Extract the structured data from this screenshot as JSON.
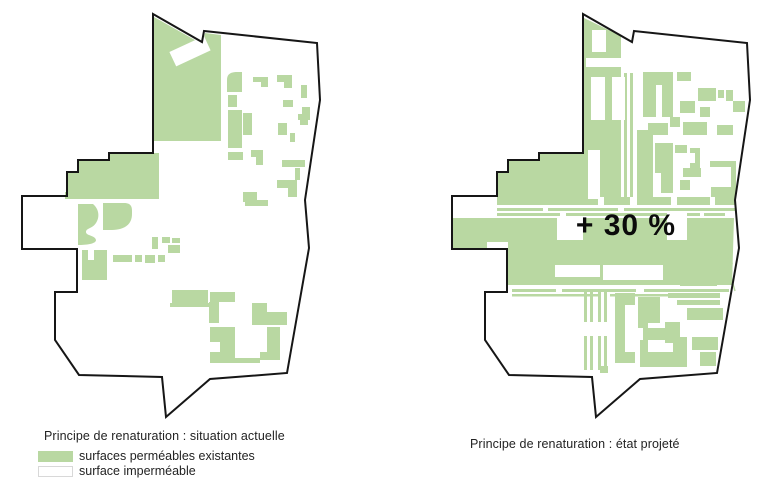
{
  "colors": {
    "permeable_green": "#b9d8a2",
    "outline": "#161616",
    "swatch_border": "#d8d8d8",
    "caption_text": "#232323",
    "annotation_text": "#0b0b0b"
  },
  "left_map": {
    "caption": "Principe de renaturation : situation actuelle",
    "legend": [
      {
        "swatch": "permeable",
        "label": "surfaces perméables existantes"
      },
      {
        "swatch": "impermeable",
        "label": "surface imperméable"
      }
    ],
    "boundary": "M153,14 L202,42 L204,31 L317,43 L320,100 L305,200 L309,248 L287,373 L210,379 L166,417 L162,377 L79,375 L55,340 L55,292 L77,292 L77,249 L22,249 L22,196 L67,196 L67,172 L78,172 L78,160 L109,160 L109,153 L153,153 Z",
    "green_shapes": [
      "M154,17 L202,44 L205,33 L221,35 L221,141 L154,141 Z",
      "M109,153 L159,153 L159,199 L65,199 L65,192 L67,192 L67,172 L78,172 L78,160 L109,160 Z",
      "M78,204 L93,204 C99,209 100,217 96,223 C92,229 86,228 86,232 C86,236 95,235 96,240 C96,244 86,245 78,245 Z",
      "M103,203 L124,203 C131,203 132,207 132,211 L132,214 C132,226 122,230 112,230 L103,230 Z",
      "M82,250 L88,250 L88,260 L94,260 L94,250 L107,250 L107,280 L82,280 Z",
      [
        113,
        255,
        19,
        7
      ],
      [
        135,
        255,
        7,
        7
      ],
      [
        145,
        255,
        10,
        8
      ],
      [
        158,
        255,
        7,
        7
      ],
      [
        152,
        237,
        6,
        12
      ],
      [
        162,
        237,
        8,
        6
      ],
      [
        172,
        238,
        8,
        5
      ],
      [
        168,
        245,
        12,
        8
      ],
      "M227,92 L227,80 C227,73 232,72 238,72 L242,72 L242,92 Z",
      "M253,77 L268,77 L268,87 L261,87 L261,82 L253,82 Z",
      "M277,75 L292,75 L292,88 L284,88 L284,82 L277,82 Z",
      [
        301,
        85,
        6,
        13
      ],
      [
        228,
        95,
        9,
        12
      ],
      [
        228,
        110,
        14,
        38
      ],
      [
        243,
        113,
        9,
        22
      ],
      [
        283,
        100,
        10,
        7
      ],
      "M302,107 L310,107 L310,120 L298,120 L298,114 L302,114 Z",
      [
        278,
        123,
        9,
        12
      ],
      [
        290,
        133,
        5,
        9
      ],
      [
        300,
        120,
        8,
        5
      ],
      [
        228,
        152,
        15,
        8
      ],
      "M251,150 L263,150 L263,165 L256,165 L256,157 L251,157 Z",
      [
        282,
        160,
        23,
        7
      ],
      [
        295,
        168,
        5,
        12
      ],
      "M277,180 L297,180 L297,197 L288,197 L288,188 L277,188 Z",
      [
        243,
        192,
        14,
        10
      ],
      [
        245,
        200,
        23,
        6
      ],
      [
        172,
        290,
        36,
        13
      ],
      [
        170,
        303,
        39,
        4
      ],
      [
        210,
        292,
        25,
        10
      ],
      [
        209,
        302,
        10,
        21
      ],
      "M210,327 L235,327 L235,363 L210,363 L210,352 L220,352 L220,342 L210,342 Z",
      "M252,303 L267,303 L267,312 L287,312 L287,325 L252,325 Z",
      "M267,327 L280,327 L280,360 L260,360 L260,352 L267,352 Z",
      [
        235,
        358,
        25,
        5
      ]
    ],
    "white_shapes": [
      "M204,36 L210.6,50.4 L176.2,66.4 L169.4,52 Z"
    ]
  },
  "right_map": {
    "caption": "Principe de renaturation : état projeté",
    "annotation": "+ 30 %",
    "boundary": "M583,14 L632,42 L634,31 L747,43 L750,100 L735,200 L739,248 L717,373 L640,379 L596,417 L592,377 L509,375 L485,340 L485,292 L507,292 L507,249 L452,249 L452,196 L497,196 L497,172 L508,172 L508,160 L539,160 L539,153 L583,153 Z",
    "green_shapes": [
      "M584,18 L621,36 L621,150 L584,150 Z",
      [
        584,
        150,
        37,
        47
      ],
      "M539,154 L584,154 L584,199 L497,199 L497,172 L508,172 L508,160 L539,160 Z",
      [
        497,
        197,
        101,
        8
      ],
      [
        604,
        197,
        26,
        8
      ],
      [
        637,
        197,
        34,
        8
      ],
      [
        677,
        197,
        33,
        8
      ],
      [
        715,
        197,
        20,
        8
      ],
      [
        497,
        208,
        46,
        3
      ],
      [
        548,
        208,
        70,
        3
      ],
      [
        624,
        208,
        111,
        3
      ],
      [
        497,
        213,
        63,
        3
      ],
      [
        566,
        213,
        134,
        3
      ],
      [
        704,
        213,
        21,
        3
      ],
      "M453,218 L734,218 L732,285 L507,285 L507,249 L453,249 Z",
      [
        512,
        289,
        44,
        3
      ],
      [
        562,
        289,
        74,
        3
      ],
      [
        644,
        289,
        85,
        3
      ],
      [
        512,
        294,
        88,
        2.5
      ],
      [
        610,
        294,
        80,
        2.5
      ],
      [
        680,
        283,
        37,
        3
      ],
      [
        624,
        73,
        3,
        124
      ],
      [
        630,
        73,
        3,
        124
      ],
      [
        643,
        72,
        30,
        45
      ],
      [
        677,
        72,
        14,
        9
      ],
      [
        698,
        88,
        18,
        13
      ],
      [
        726,
        90,
        7,
        11
      ],
      [
        680,
        101,
        15,
        12
      ],
      [
        700,
        107,
        10,
        10
      ],
      [
        733,
        101,
        12,
        11
      ],
      [
        670,
        117,
        10,
        10
      ],
      [
        648,
        123,
        20,
        12
      ],
      [
        683,
        122,
        24,
        13
      ],
      [
        717,
        125,
        16,
        10
      ],
      [
        718,
        90,
        6,
        8
      ],
      [
        637,
        130,
        16,
        73
      ],
      "M655,143 L673,143 L673,193 L661,193 L661,173 L655,173 Z",
      [
        675,
        145,
        12,
        8
      ],
      [
        690,
        148,
        10,
        20
      ],
      [
        683,
        168,
        18,
        9
      ],
      [
        680,
        180,
        10,
        10
      ],
      "M710,161 L736,161 L736,197 L731,197 L731,167 L710,167 Z",
      [
        711,
        187,
        20,
        10
      ],
      [
        584,
        292,
        3,
        30
      ],
      [
        584,
        336,
        3,
        34
      ],
      [
        590,
        292,
        3,
        30
      ],
      [
        590,
        336,
        3,
        34
      ],
      [
        598,
        292,
        3,
        30
      ],
      [
        598,
        336,
        3,
        34
      ],
      [
        604,
        292,
        3,
        30
      ],
      [
        604,
        336,
        3,
        34
      ],
      "M615,293 L635,293 L635,305 L625,305 L625,352 L635,352 L635,363 L615,363 Z",
      [
        638,
        297,
        22,
        26
      ],
      [
        638,
        323,
        10,
        5
      ],
      [
        665,
        322,
        15,
        21
      ],
      [
        668,
        293,
        52,
        5
      ],
      [
        677,
        300,
        43,
        5
      ],
      [
        687,
        308,
        36,
        12
      ],
      [
        692,
        337,
        26,
        13
      ],
      [
        700,
        352,
        16,
        14
      ],
      "M642,352 L673,352 L673,337 L687,337 L687,367 L642,367 Z",
      [
        640,
        340,
        8,
        27
      ],
      [
        643,
        328,
        24,
        12
      ],
      [
        600,
        366,
        8,
        7
      ]
    ],
    "white_shapes": [
      [
        592,
        30,
        14,
        22
      ],
      [
        586,
        58,
        35,
        9
      ],
      [
        591,
        77,
        14,
        43
      ],
      [
        612,
        77,
        13,
        43
      ],
      [
        588,
        150,
        12,
        49
      ],
      [
        557,
        216,
        26,
        24
      ],
      [
        667,
        212,
        20,
        28
      ],
      [
        555,
        265,
        45,
        12
      ],
      [
        603,
        265,
        60,
        15
      ],
      [
        487,
        242,
        21,
        10
      ],
      [
        656,
        85,
        6,
        32
      ],
      [
        690,
        153,
        5,
        10
      ]
    ],
    "fan_strokes": [
      "M706,258 L727,252 L732,263 L713,272 Z",
      "M731,277 L706,258",
      "M731,277 L727,252",
      "M731,277 L732,263",
      "M731,277 L713,272",
      "M731,277 L718,255",
      "M731,277 L735,291"
    ]
  }
}
